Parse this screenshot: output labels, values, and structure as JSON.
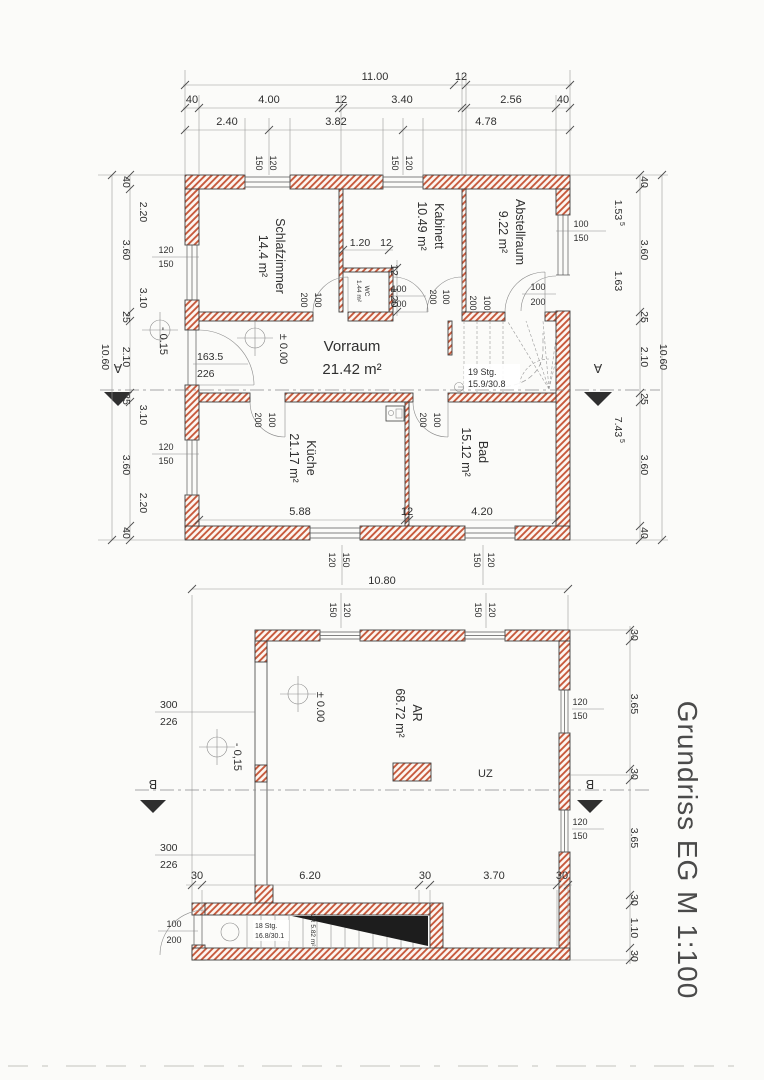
{
  "title": "Grundriss EG M 1:100",
  "colors": {
    "hatch": "#c75a3d",
    "wall_line": "#3f3f3f",
    "dim_text": "#2f2f2f",
    "section_cut": "#1d1d1d"
  },
  "tok": {
    "n100": "100",
    "n120": "120",
    "n150": "150",
    "n200": "200"
  },
  "upper": {
    "dim_total_w": "11.00",
    "dim_12_top": "12",
    "row2": [
      "40",
      "4.00",
      "12",
      "3.40",
      "2.56",
      "40"
    ],
    "row3": [
      "2.40",
      "3.82",
      "4.78"
    ],
    "left_chain": [
      "40",
      "2.20",
      "3.60",
      "3.10",
      "25",
      "2.10",
      "25",
      "3.10",
      "3.60",
      "2.20",
      "40"
    ],
    "left_total": "10.60",
    "right_chain": [
      "40",
      "3.60",
      "25",
      "2.10",
      "25",
      "3.60",
      "40"
    ],
    "right_inner": [
      "1.53",
      "1.63",
      "7.43"
    ],
    "right_sup": "5",
    "right_total": "10.60",
    "inner_bottom": [
      "5.88",
      "12",
      "4.20"
    ],
    "wc_dim_h": [
      "1.20",
      "12"
    ],
    "wc_dim_v": [
      "12",
      "1.20"
    ],
    "rooms": {
      "schlafzimmer": {
        "n": "Schlafzimmer",
        "a": "14.4 m²"
      },
      "wc": {
        "n": "WC",
        "a": "1.44 m²"
      },
      "kabinett": {
        "n": "Kabinett",
        "a": "10.49 m²"
      },
      "abstellraum": {
        "n": "Abstellraum",
        "a": "9.22 m²"
      },
      "vorraum": {
        "n": "Vorraum",
        "a": "21.42 m²"
      },
      "kueche": {
        "n": "Küche",
        "a": "21.17 m²"
      },
      "bad": {
        "n": "Bad",
        "a": "15.12 m²"
      }
    },
    "level_zero": "± 0.00",
    "level_minus": "- 0.15",
    "entry_w": "163.5",
    "entry_h": "226",
    "stair1": "19 Stg.",
    "stair2": "15.9/30.8"
  },
  "mid": {
    "dim_total": "10.80"
  },
  "lower": {
    "bottom_chain": [
      "30",
      "6.20",
      "30",
      "3.70",
      "30"
    ],
    "right_chain": [
      "30",
      "3.65",
      "30",
      "3.65",
      "30",
      "1.10",
      "30"
    ],
    "room": {
      "n": "AR",
      "a": "68.72 m²"
    },
    "level_zero": "± 0.00",
    "level_minus": "- 0,15",
    "wall_a": "300",
    "wall_b": "226",
    "uz": "UZ",
    "stair1": "18 Stg.",
    "stair2": "16.8/30.1",
    "stair_vr": "VR 5.82 m²"
  },
  "sections": {
    "a": "A",
    "b": "B"
  }
}
